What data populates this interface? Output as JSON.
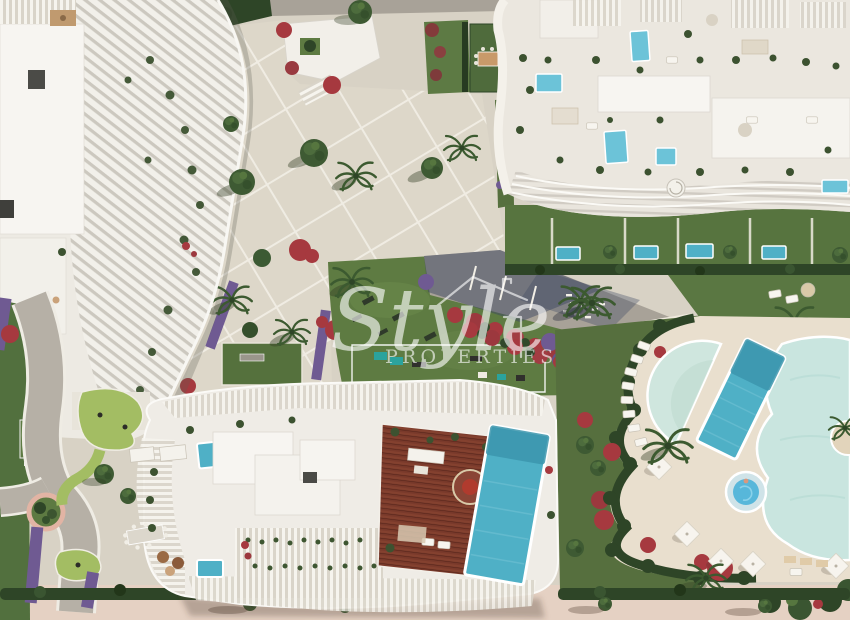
{
  "watermark": {
    "script_word": "Style",
    "caps_word": "PROPERTIES",
    "house_icon": "house-roof-outline-icon",
    "color": "#ffffff"
  },
  "palette": {
    "paving": "#d8d2c5",
    "plaza": "#ddd7c9",
    "pooldeck": "#e9dfce",
    "promenade": "#e5d1c3",
    "lawn": "#5e7b42",
    "lawnbright": "#6f8c4d",
    "minigolf": "#a3bd63",
    "hedge": "#2e4527",
    "pool": "#4fb0c6",
    "pooldark": "#3b95ad",
    "rooftoppool": "#6cc3d8",
    "lagoon": "#c9e5df",
    "kidspool": "#cfe6de",
    "jacuzzi": "#57b7da",
    "wood": "#7a3a2b",
    "building": "#efece6",
    "roof": "#f7f5f1",
    "road": "#a8a298",
    "roadshadow": "#3d4862",
    "red": "#a6393f",
    "purple": "#6f5a92",
    "pinkring": "#e2b4a4",
    "path": "#b6b0a6"
  }
}
